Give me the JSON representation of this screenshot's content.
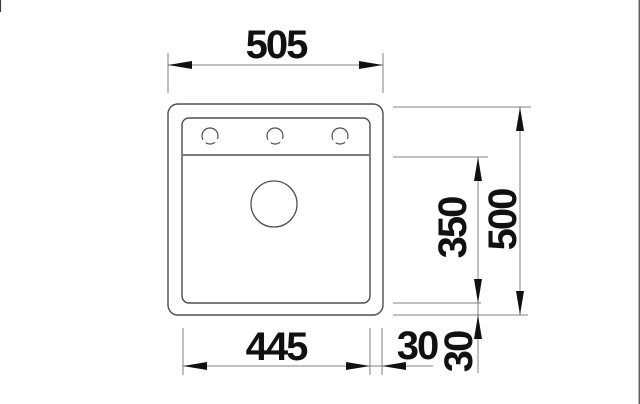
{
  "drawing": {
    "type": "sink-installation-dimension-drawing",
    "labels": {
      "overall_width": "505",
      "overall_depth": "500",
      "bowl_depth": "350",
      "bowl_width": "445",
      "side_rim": "30",
      "bottom_rim": "30"
    },
    "colors": {
      "outline": "#4d4d4d",
      "dimension_line": "#808080",
      "arrow_and_text": "#111111",
      "background": "#ffffff"
    }
  }
}
